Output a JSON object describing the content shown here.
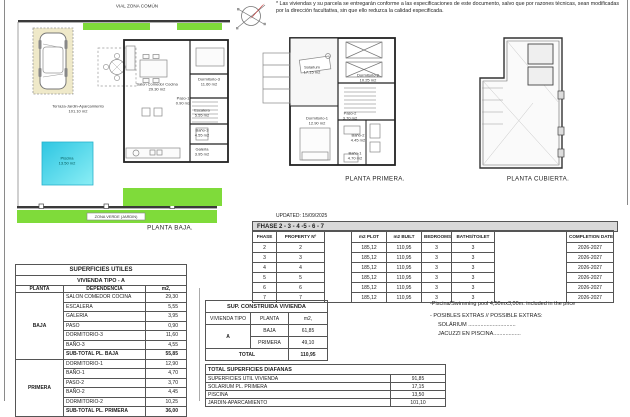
{
  "disclaimer": "* Las viviendas y su parcela se entregarán conforme a las especificaciones de este documento, salvo que por razones técnicas, sean modificadas por la dirección facultativa, sin que ello reduzca la calidad especificada.",
  "updated": "UPDATED: 15/09/2025",
  "colors": {
    "green": "#7fdb3a",
    "pool_dark": "#2ec6e2",
    "pool_light": "#8beef5",
    "sand": "#efe9c9",
    "header_gray": "#d9d9d9"
  },
  "plan_baja": {
    "street": "VIAL ZONA COMÚN",
    "zona_verde": "ZONA VERDE (JARDIN)",
    "caption": "PLANTA BAJA.",
    "terraza_name": "Terraza-Jardin-Aparcamiento",
    "terraza_area": "101.10 m2",
    "piscina_name": "Piscina",
    "piscina_area": "13.50 m2",
    "rooms": {
      "salon": {
        "name": "Salon  Comedor  Cocina",
        "area": "29.30 m2"
      },
      "dorm3": {
        "name": "Dormitorio-3",
        "area": "11.60 m2"
      },
      "paso1": {
        "name": "Paso-1",
        "area": "0.90 m2"
      },
      "escalera": {
        "name": "Escalera",
        "area": "5.55 m2"
      },
      "bano3": {
        "name": "Baño-3",
        "area": "4.55 m2"
      },
      "galeria": {
        "name": "Galeria",
        "area": "3.95 m2"
      }
    }
  },
  "plan_primera": {
    "caption": "PLANTA PRIMERA.",
    "rooms": {
      "solarium": {
        "name": "Solarium",
        "area": "17.15 m2"
      },
      "dorm2": {
        "name": "Dormitorio-2",
        "area": "10.25 m2"
      },
      "paso2": {
        "name": "Paso-2",
        "area": "3.70 m2"
      },
      "dorm1": {
        "name": "Dormitorio-1",
        "area": "12.90 m2"
      },
      "bano2": {
        "name": "Baño-2",
        "area": "4.45 m2"
      },
      "bano1": {
        "name": "Baño-1",
        "area": "4.70 m2"
      }
    }
  },
  "plan_cubierta": {
    "caption": "PLANTA CUBIERTA."
  },
  "phase_table": {
    "title": "FHASE  2 - 3 - 4 -5 - 6 - 7",
    "headers": {
      "phase": "FHASE",
      "property": "PROPERTY Nº",
      "plot": "m2 PLOT",
      "built": "m2 BUILT",
      "bedrooms": "BEDROOMS",
      "baths": "BATHS/TOILET",
      "completion": "COMPLETION DATE"
    },
    "rows": [
      {
        "phase": "2",
        "property": "2",
        "plot": "185,12",
        "built": "110,95",
        "bedrooms": "3",
        "baths": "3",
        "completion": "2026-2027"
      },
      {
        "phase": "3",
        "property": "3",
        "plot": "185,12",
        "built": "110,95",
        "bedrooms": "3",
        "baths": "3",
        "completion": "2026-2027"
      },
      {
        "phase": "4",
        "property": "4",
        "plot": "185,12",
        "built": "110,95",
        "bedrooms": "3",
        "baths": "3",
        "completion": "2026-2027"
      },
      {
        "phase": "5",
        "property": "5",
        "plot": "185,12",
        "built": "110,95",
        "bedrooms": "3",
        "baths": "3",
        "completion": "2026-2027"
      },
      {
        "phase": "6",
        "property": "6",
        "plot": "185,12",
        "built": "110,95",
        "bedrooms": "3",
        "baths": "3",
        "completion": "2026-2027"
      },
      {
        "phase": "7",
        "property": "7",
        "plot": "185,12",
        "built": "110,95",
        "bedrooms": "3",
        "baths": "3",
        "completion": "2026-2027"
      }
    ]
  },
  "utiles_table": {
    "title": "SUPERFICIES UTILES",
    "subtitle": "VIVIENDA TIPO - A",
    "headers": {
      "planta": "PLANTA",
      "dependencia": "DEPENDENCIA",
      "m2": "m2,"
    },
    "baja_label": "BAJA",
    "baja_rows": [
      {
        "name": "SALON COMEDOR COCINA",
        "m2": "29,30"
      },
      {
        "name": "ESCALERA",
        "m2": "5,55"
      },
      {
        "name": "GALERIA",
        "m2": "3,95"
      },
      {
        "name": "PASO",
        "m2": "0,90"
      },
      {
        "name": "DORMITORIO-3",
        "m2": "11,60"
      },
      {
        "name": "BAÑO-3",
        "m2": "4,55"
      }
    ],
    "baja_subtotal": {
      "name": "SUB-TOTAL PL. BAJA",
      "m2": "55,85"
    },
    "primera_label": "PRIMERA",
    "primera_rows": [
      {
        "name": "DORMITORIO-1",
        "m2": "12,90"
      },
      {
        "name": "BAÑO-1",
        "m2": "4,70"
      },
      {
        "name": "PASO-2",
        "m2": "3,70"
      },
      {
        "name": "BAÑO-2",
        "m2": "4,45"
      },
      {
        "name": "DORMITORIO-2",
        "m2": "10,25"
      }
    ],
    "primera_subtotal": {
      "name": "SUB-TOTAL PL. PRIMERA",
      "m2": "36,00"
    }
  },
  "construida_table": {
    "title": "SUP. CONSTRUIDA VIVIENDA",
    "headers": {
      "tipo": "VIVIENDA TIPO",
      "planta": "PLANTA",
      "m2": "m2,"
    },
    "tipo": "A",
    "rows": [
      {
        "planta": "BAJA",
        "m2": "61,85"
      },
      {
        "planta": "PRIMERA",
        "m2": "49,10"
      }
    ],
    "total_label": "TOTAL",
    "total": "110,95"
  },
  "diafanas_table": {
    "title": "TOTAL SUPERFICIES DIAFANAS",
    "rows": [
      {
        "name": "SUPERFICIES UTIL VIVIENDA",
        "m2": "91,85"
      },
      {
        "name": "SOLARIUM PL. PRIMERA",
        "m2": "17,15"
      },
      {
        "name": "PISCINA",
        "m2": "13,50"
      },
      {
        "name": "JARDIN-APARCAMIENTO",
        "m2": "101,10"
      }
    ]
  },
  "notes": {
    "pool": "-Piscina/Swimming pool 4,50mx3,00m. included in the price",
    "extras_title": "- POSIBLES EXTRAS // POSSIBLE EXTRAS:",
    "extra1": "SOLÁRIUM ...............................",
    "extra2": "JACUZZI EN PISCINA.................."
  }
}
